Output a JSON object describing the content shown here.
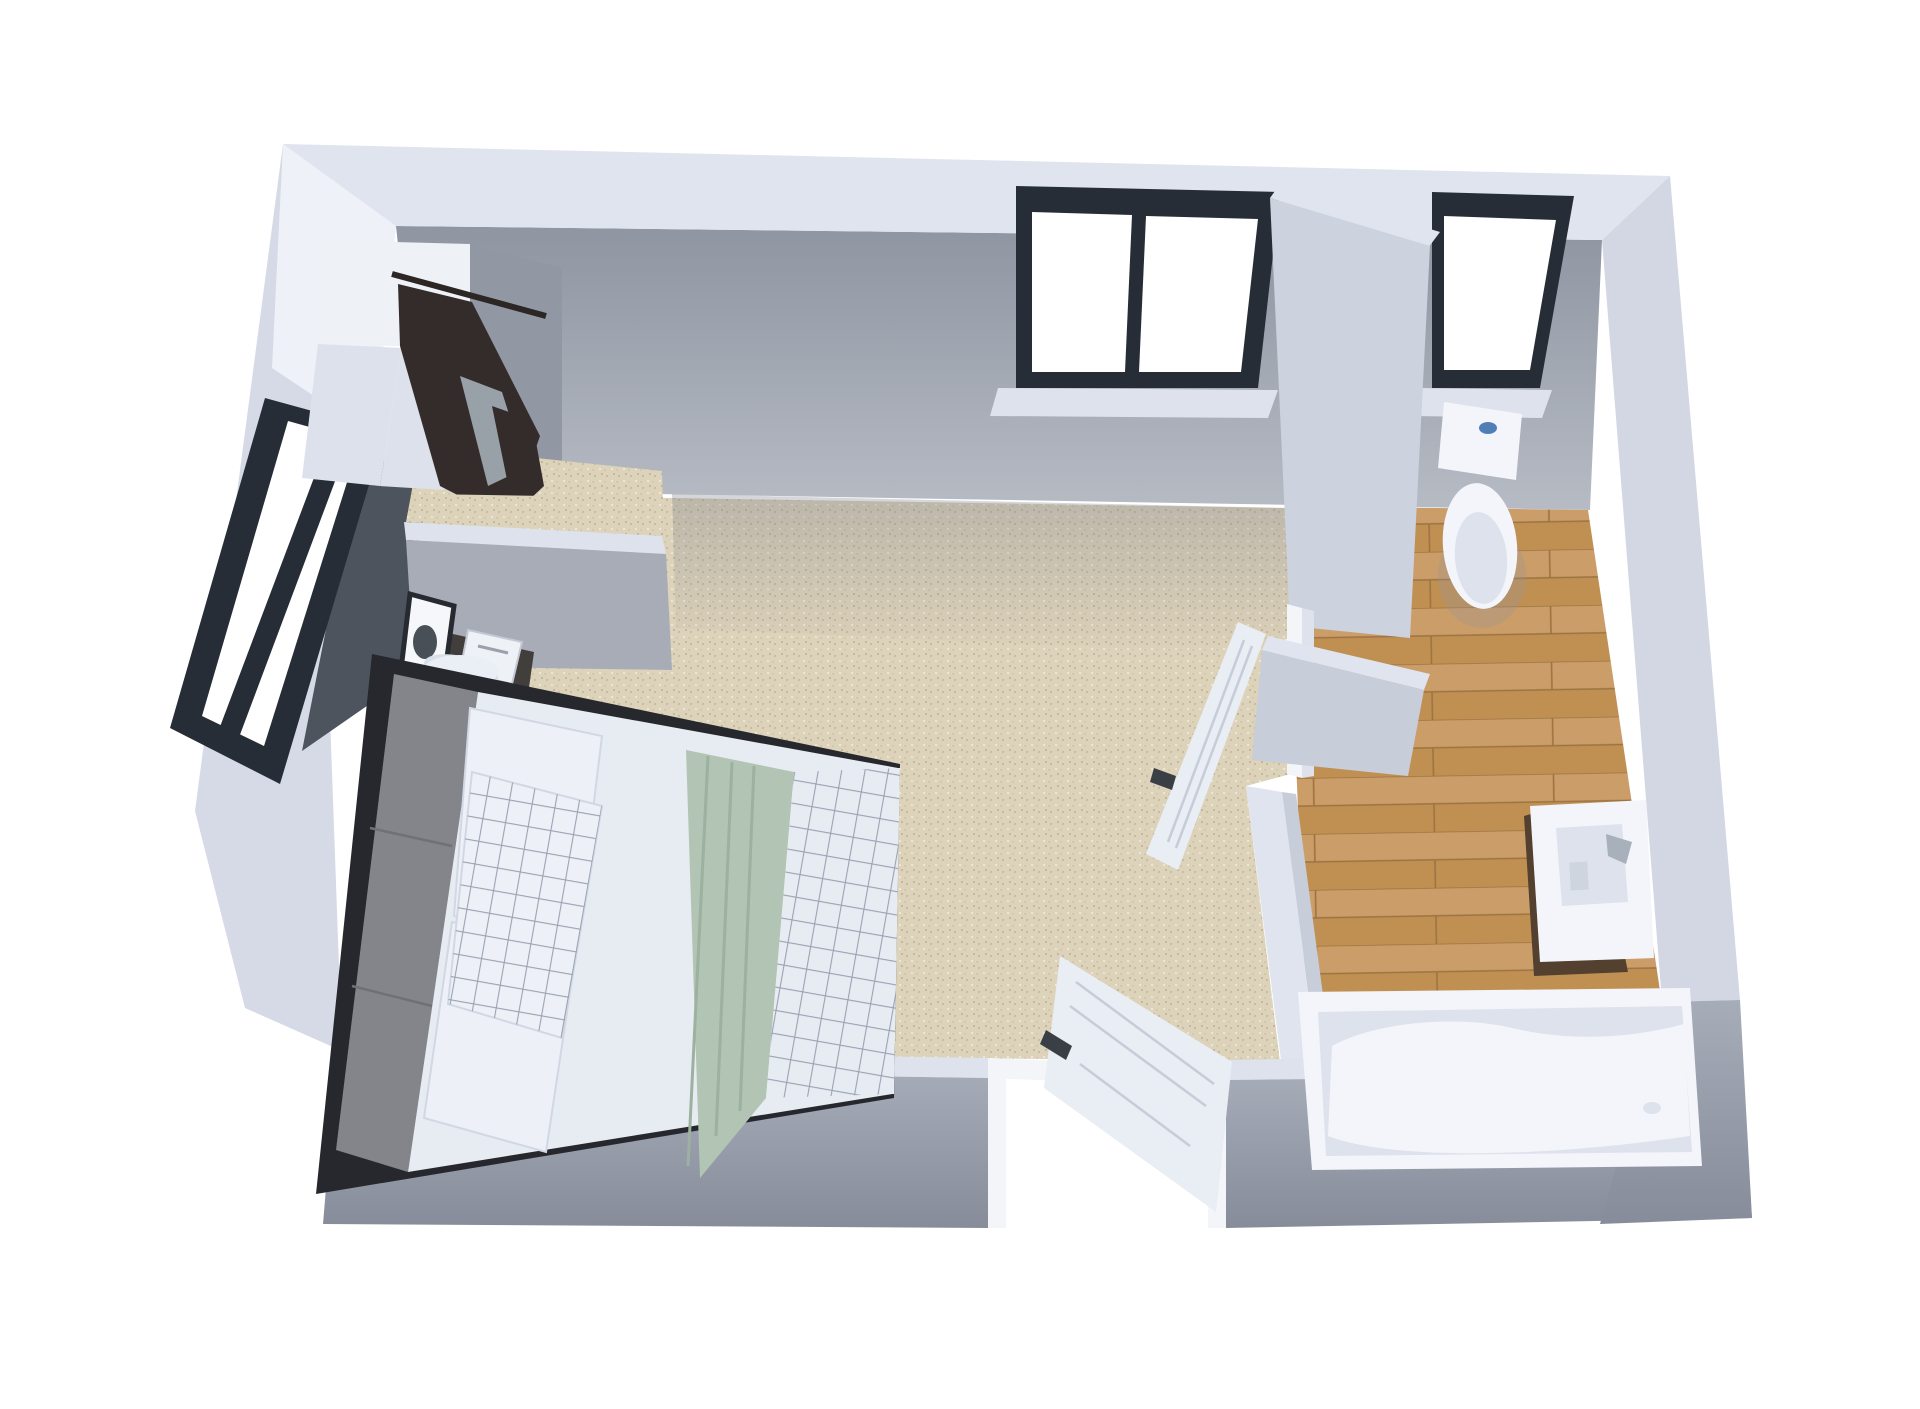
{
  "scene": {
    "type": "3d-floorplan-render",
    "view": "overhead-dollhouse",
    "rooms": [
      {
        "id": "bedroom",
        "floor": "carpet",
        "objects": [
          "double-bed",
          "headboard-cushions",
          "white-pillows",
          "checkered-pillow",
          "white-duvet",
          "sage-throw-blanket",
          "checkered-foot-blanket",
          "nightstand",
          "table-lamp",
          "picture-frame",
          "magazine",
          "wardrobe-nook",
          "hanging-clothes",
          "north-window-two-pane",
          "west-window",
          "entry-door-open"
        ]
      },
      {
        "id": "bathroom",
        "floor": "wood-planks",
        "objects": [
          "toilet",
          "vanity-with-sink",
          "faucet",
          "bathtub",
          "north-window-single-pane",
          "bathroom-door-open"
        ]
      }
    ],
    "openings": {
      "entry-door": "south-wall, open inward",
      "bathroom-door": "west-partition, open into bedroom",
      "windows": 3
    }
  },
  "colors": {
    "background": "#ffffff",
    "wall_top": "#dfe4ee",
    "wall_top_bright": "#eef1f7",
    "wall_band_west": "#d5dae6",
    "wall_band_right": "#d2d7e3",
    "wall_face_mid": "#a7acb7",
    "wall_face_dark": "#4e545e",
    "wall_face_column": "#ccd2de",
    "wall_face_block": "#c7cdd9",
    "window_sill": "#dde2ec",
    "window_frame": "#272d36",
    "window_glass": "#ffffff",
    "floor_carpet": "#ddd2ba",
    "carpet_speck_1": "#c7ba9c",
    "carpet_speck_2": "#efe8d5",
    "carpet_speck_3": "#b3a687",
    "floor_wood": "#cb9d68",
    "floor_wood_dark": "#c09053",
    "floor_wood_seam": "#9c7342",
    "bed_frame": "#26282d",
    "headboard": "#83858b",
    "headboard_seam": "#6f7177",
    "duvet": "#e7ebf2",
    "pillow": "#edf0f6",
    "pillow_edge": "#d2d8e3",
    "pillow_grid": "#9aa3b3",
    "blanket_green": "#b2c4b4",
    "blanket_green_fold": "#9db1a0",
    "nightstand": "#423e3b",
    "lamp_body": "#d9dfe9",
    "lamp_top": "#eaeef5",
    "clothes_dark": "#332c2a",
    "clothes_gray": "#98a0a8",
    "fixture_white": "#f3f5fa",
    "fixture_shadow": "#dde2ec",
    "vanity_cabinet": "#53402f",
    "faucet": "#a8b0bb",
    "toilet_button": "#4f7fb5",
    "door_leaf": "#e9edf4",
    "door_line": "#c6ccd8",
    "door_handle": "#3a3f46",
    "door_jamb": "#f3f5f9",
    "closet_white": "#eef1f6",
    "closet_shade": "#dce1eb",
    "nook_back": "#9298a3"
  }
}
